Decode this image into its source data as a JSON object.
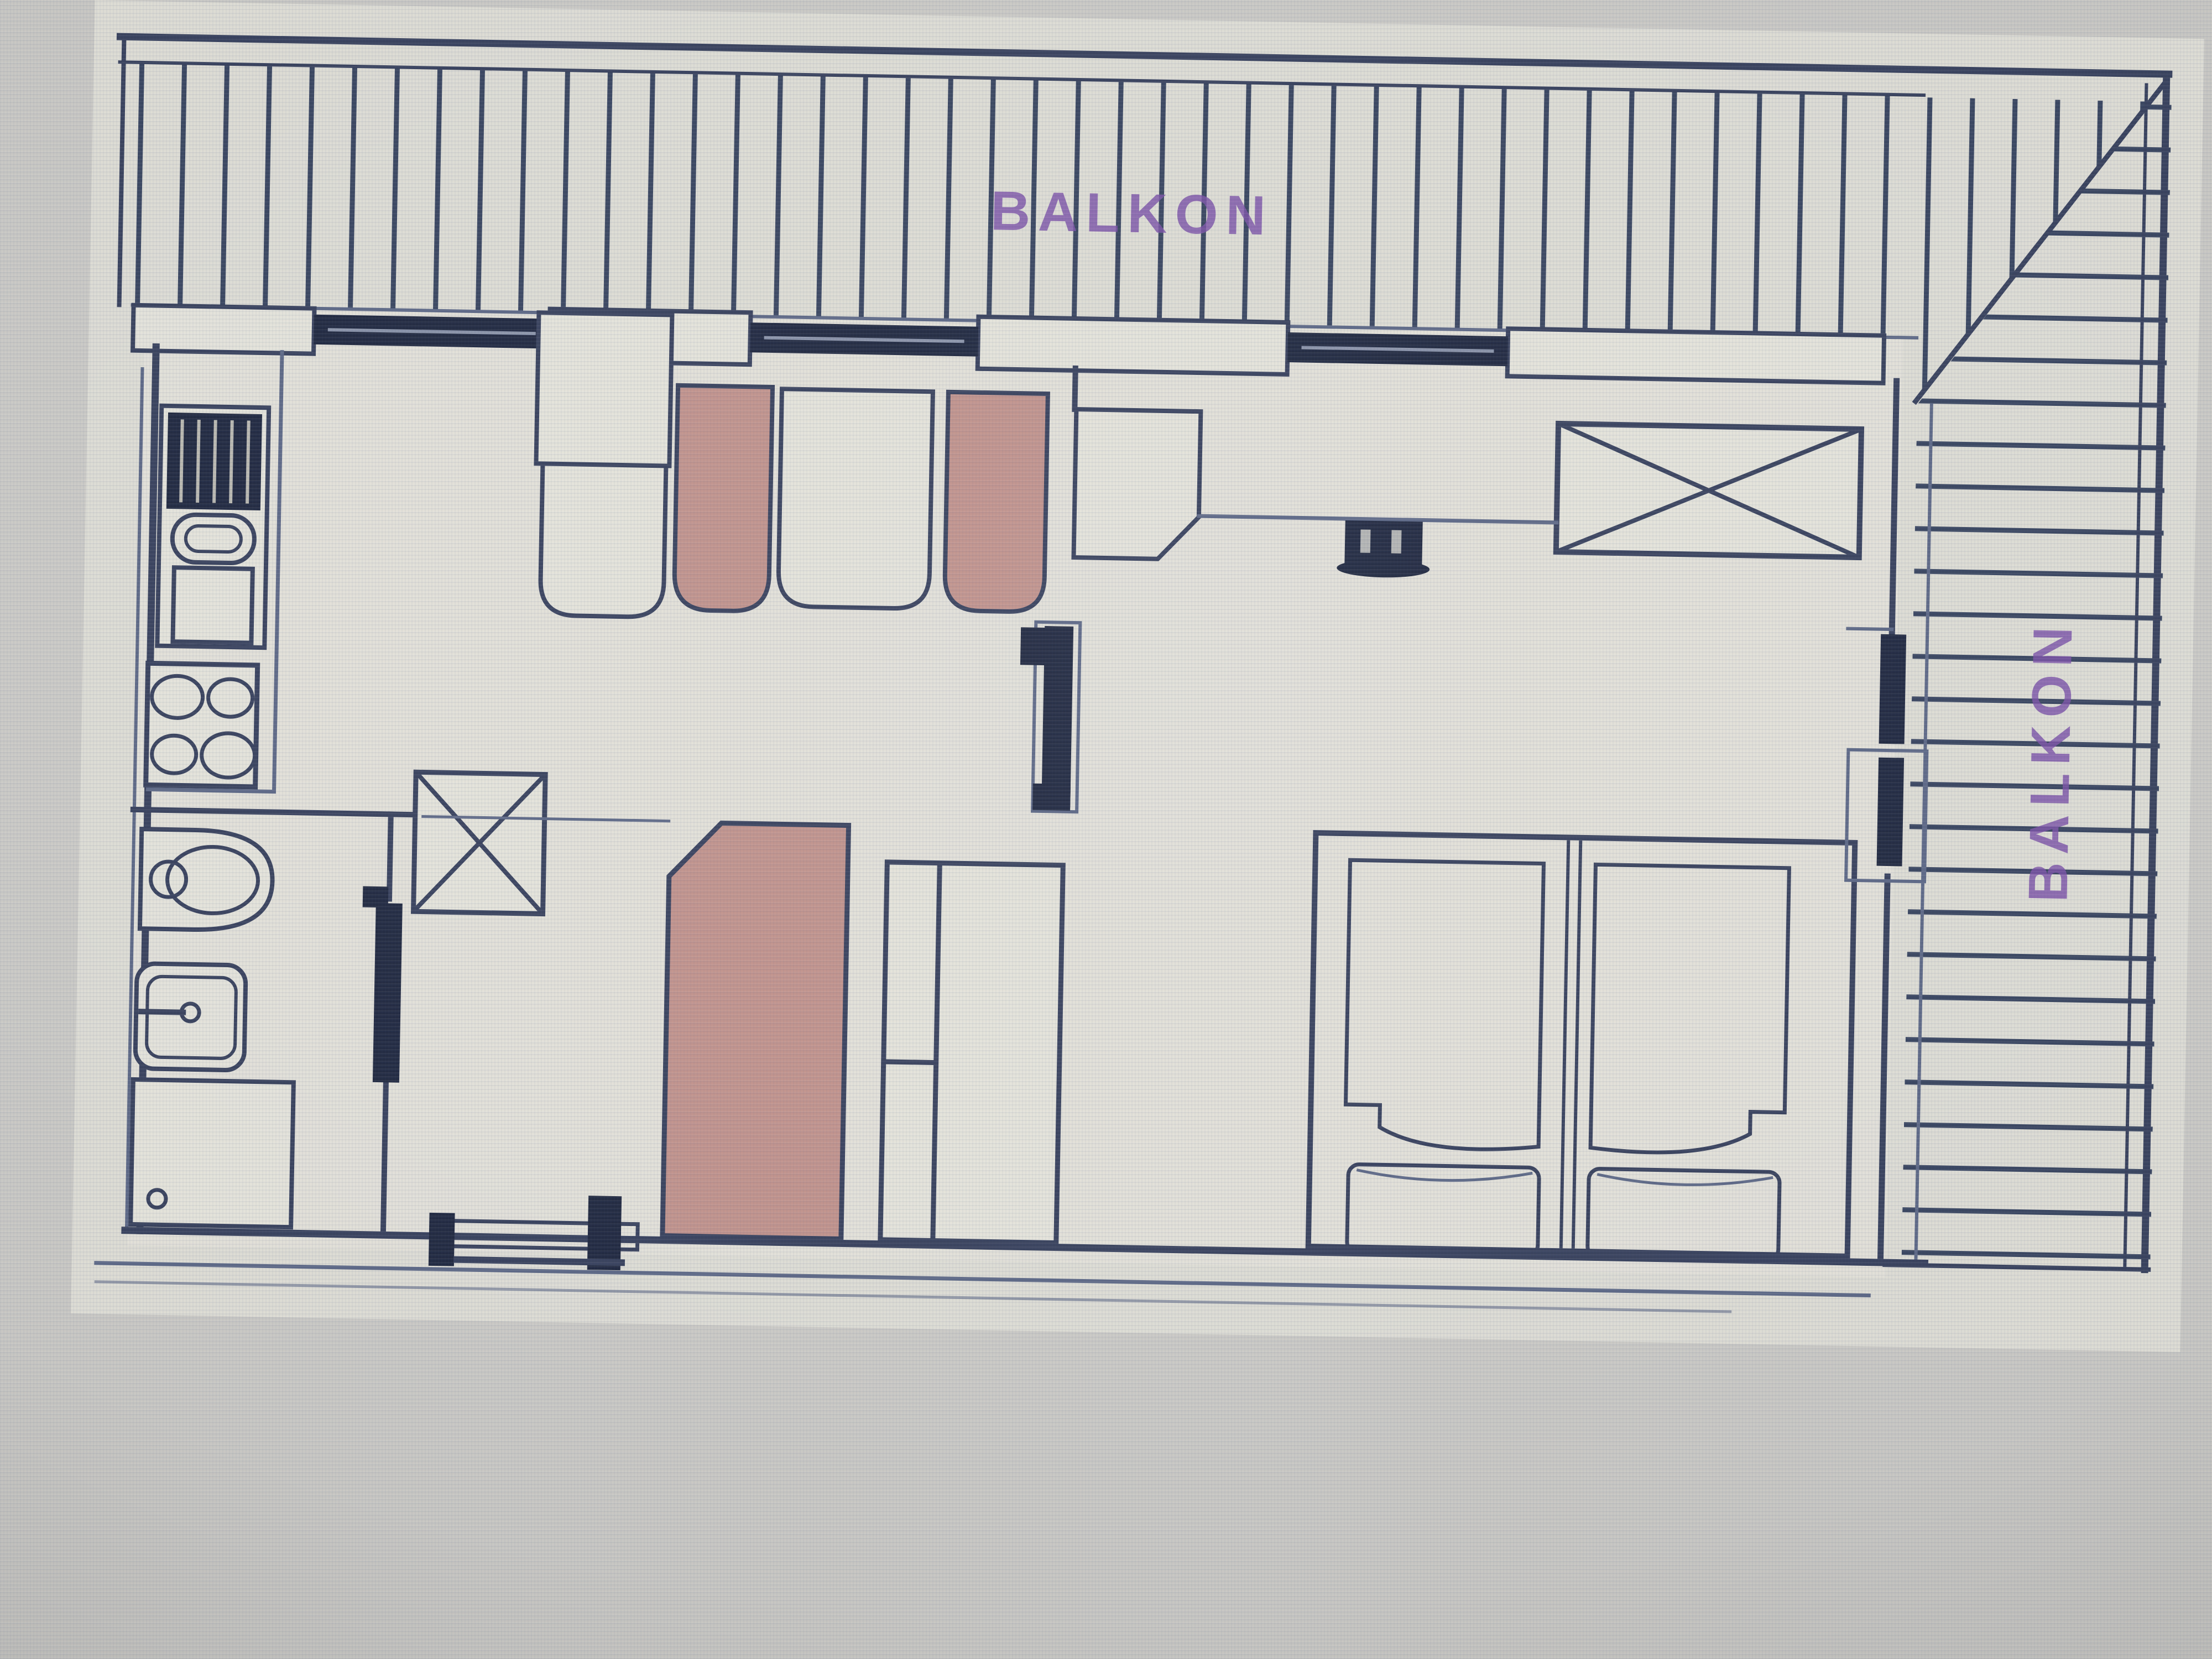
{
  "labels": {
    "balcony_top": "BALKON",
    "balcony_right": "BALKON"
  },
  "colors": {
    "screen": "#c8c7c3",
    "paper": "#dcdbd3",
    "paper_light": "#e3e2d9",
    "wall": "#38415c",
    "wall_dark": "#20283f",
    "wall_light": "#5d6885",
    "pink": "#c0928b",
    "purple": "#7b52a6"
  }
}
